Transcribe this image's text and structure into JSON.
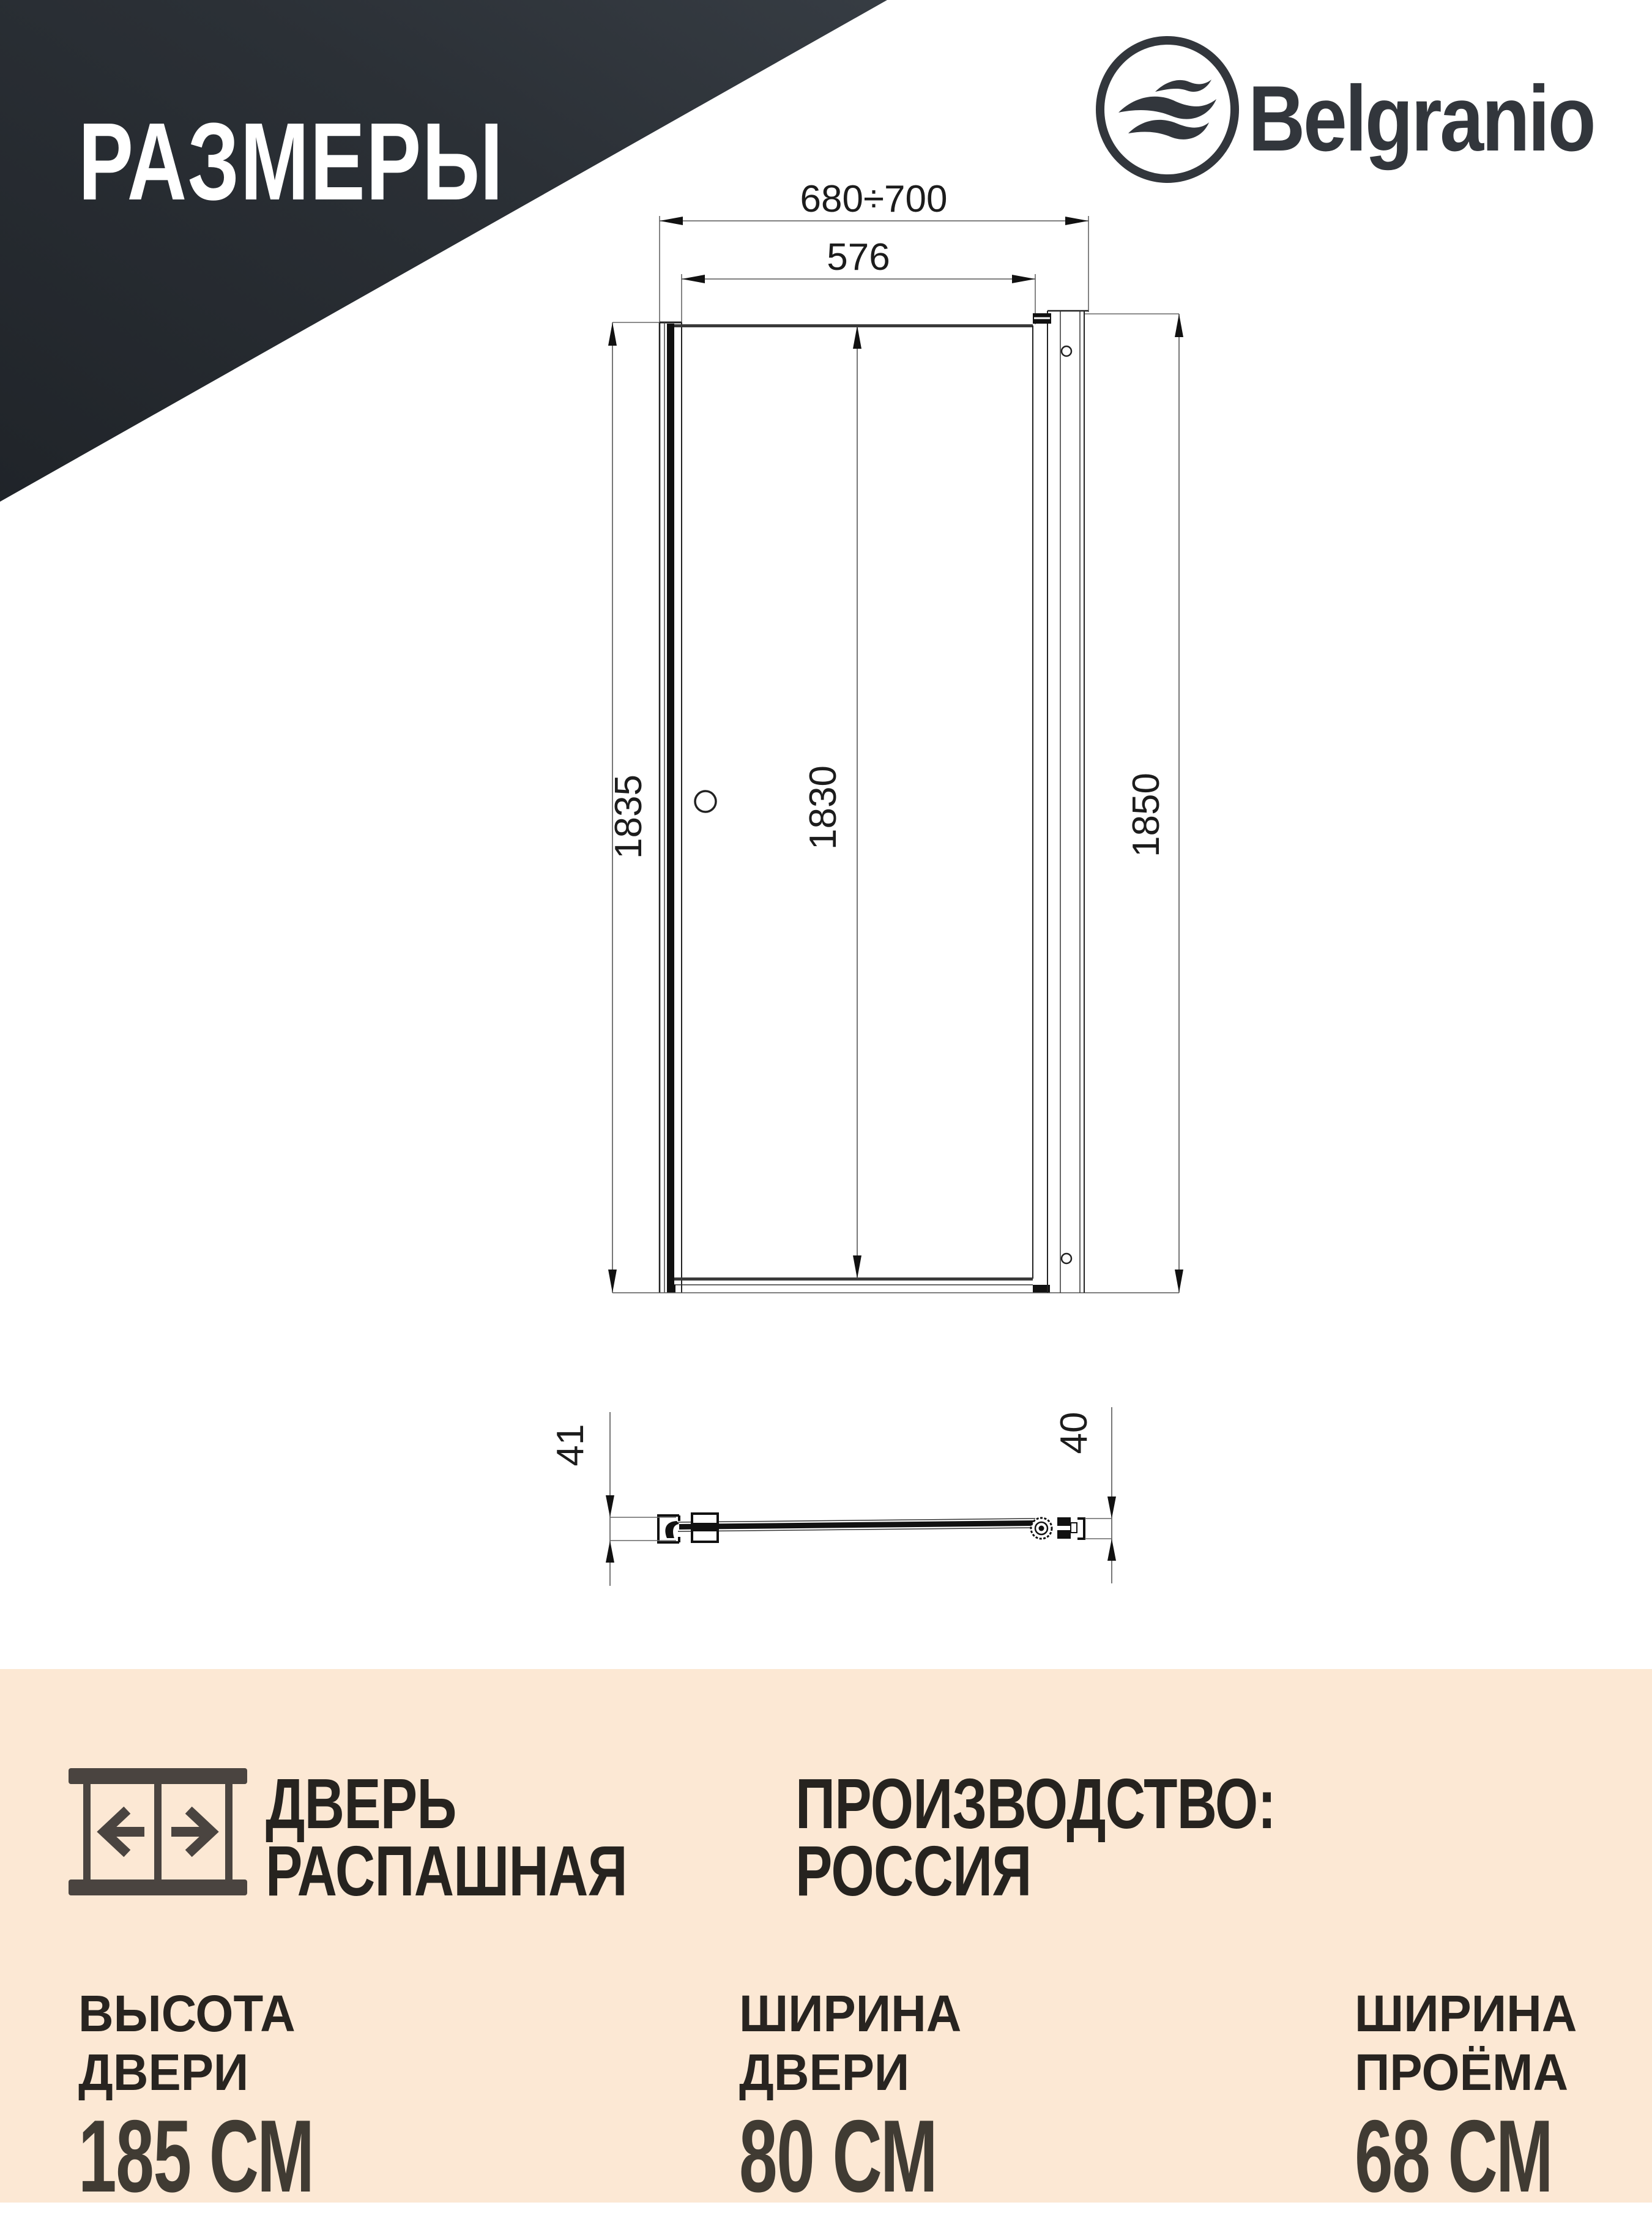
{
  "header": {
    "title": "РАЗМЕРЫ"
  },
  "logo": {
    "brand": "Belgranio"
  },
  "diagram": {
    "front_view": {
      "opening_width_range": "680÷700",
      "door_glass_width": "576",
      "left_profile_height": "1835",
      "door_height": "1830",
      "total_height": "1850"
    },
    "plan_view": {
      "left_depth": "41",
      "right_depth": "40"
    }
  },
  "footer": {
    "door_type_line1": "ДВЕРЬ",
    "door_type_line2": "РАСПАШНАЯ",
    "production_label": "ПРОИЗВОДСТВО:",
    "production_value": "РОССИЯ",
    "specs": [
      {
        "label_line1": "ВЫСОТА",
        "label_line2": "ДВЕРИ",
        "value": "185 СМ"
      },
      {
        "label_line1": "ШИРИНА",
        "label_line2": "ДВЕРИ",
        "value": "80 СМ"
      },
      {
        "label_line1": "ШИРИНА",
        "label_line2": "ПРОЁМА",
        "value": "68 СМ"
      }
    ]
  },
  "colors": {
    "banner_dark": "#2b3036",
    "peach_background": "#fce8d4",
    "ink": "#26231f",
    "drawing_line": "#333333",
    "logo_ink": "#32363c"
  }
}
